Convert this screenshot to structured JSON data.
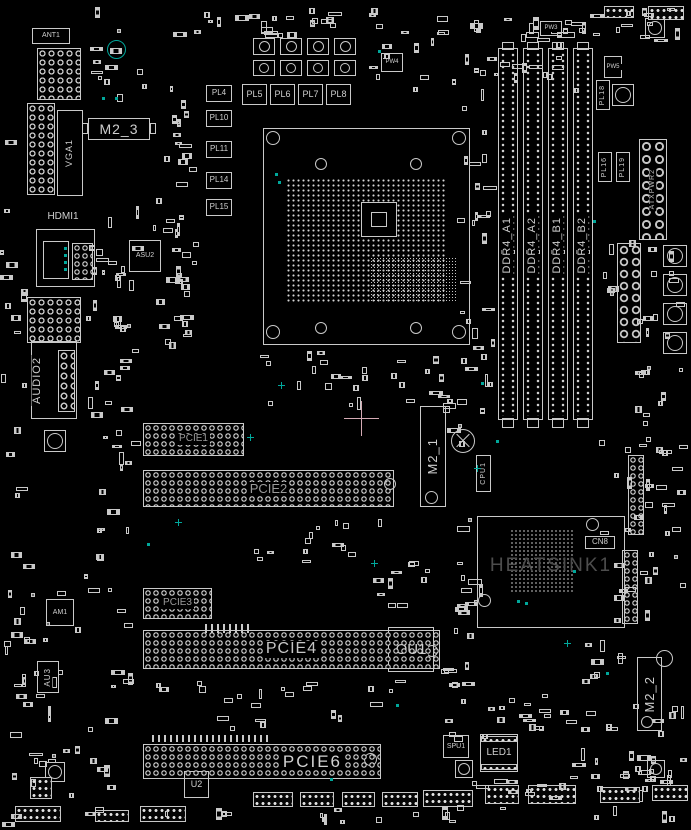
{
  "colors": {
    "background": "#000000",
    "silkscreen_line": "#c9c9c9",
    "silkscreen_text": "#cfcfcf",
    "dim_text": "#9a9a9a",
    "heatsink_text": "#4d4d4d",
    "accent_teal": "#00a79b",
    "crosshair_pink": "#d4aab4"
  },
  "connectors": {
    "ant1": "ANT1",
    "vga1": "VGA1",
    "hdmi1": "HDMI1",
    "audio2": "AUDIO2",
    "atx": "ATXPWR2",
    "led1": "LED1",
    "spu1": "SPU1",
    "cn8": "CN8",
    "cpu_fan": "CPU1"
  },
  "slots": {
    "m2_1": "M2_1",
    "m2_2": "M2_2",
    "m2_3": "M2_3",
    "pcie": [
      {
        "label": "PCIE1"
      },
      {
        "label": "PCIE2"
      },
      {
        "label": "PCIE3"
      },
      {
        "label": "PCIE4"
      },
      {
        "label": "PCIE6"
      }
    ],
    "dimms": [
      {
        "label": "DDR4_A1"
      },
      {
        "label": "DDR4_A2"
      },
      {
        "label": "DDR4_B1"
      },
      {
        "label": "DDR4_B2"
      }
    ]
  },
  "chips": {
    "ou1": "OU1",
    "u2": "U2",
    "asu2": "ASU2",
    "am1": "AM1",
    "au3": "AU3",
    "pw3": "PW3",
    "pw4": "PW4",
    "pw5": "PW5",
    "heatsink": "HEATSINK1"
  },
  "inductors": {
    "left_col": [
      {
        "label": "PL4"
      },
      {
        "label": "PL10"
      },
      {
        "label": "PL11"
      },
      {
        "label": "PL14"
      },
      {
        "label": "PL15"
      }
    ],
    "top_row": [
      {
        "label": "PL5"
      },
      {
        "label": "PL6"
      },
      {
        "label": "PL7"
      },
      {
        "label": "PL8"
      }
    ],
    "right_col": [
      {
        "label": "PL18"
      },
      {
        "label": "PL16"
      },
      {
        "label": "PL19"
      }
    ]
  }
}
